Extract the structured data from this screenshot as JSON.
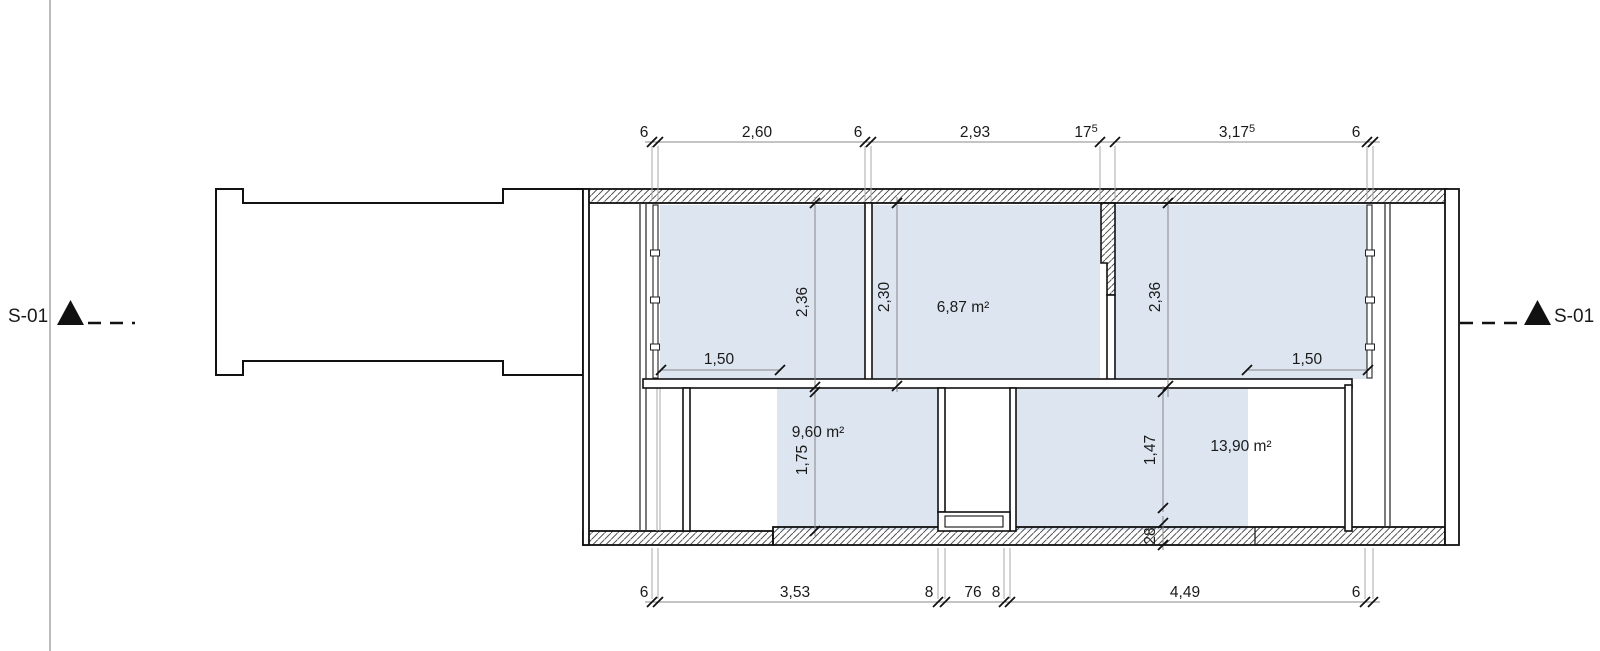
{
  "drawing": {
    "section_label_left": "S-01",
    "section_label_right": "S-01",
    "rooms": [
      {
        "name": "upper-middle-room",
        "area_label": "6,87 m²"
      },
      {
        "name": "lower-left-room",
        "area_label": "9,60 m²"
      },
      {
        "name": "lower-right-room",
        "area_label": "13,90 m²"
      }
    ],
    "dimensions": {
      "top": [
        {
          "v": "6"
        },
        {
          "v": "2,60"
        },
        {
          "v": "6"
        },
        {
          "v": "2,93"
        },
        {
          "v": "17",
          "sup": "5"
        },
        {
          "v": "3,17",
          "sup": "5"
        },
        {
          "v": "6"
        }
      ],
      "bottom": [
        {
          "v": "6"
        },
        {
          "v": "3,53"
        },
        {
          "v": "8"
        },
        {
          "v": "76"
        },
        {
          "v": "8"
        },
        {
          "v": "4,49"
        },
        {
          "v": "6"
        }
      ],
      "room_a_depth": "2,36",
      "room_b_depth": "2,30",
      "room_c_depth": "2,36",
      "lower_left_height": "1,75",
      "lower_right_height": "1,47",
      "bottom_wall_thickness": "28",
      "left_window_width": "1,50",
      "right_window_width": "1,50"
    },
    "colors": {
      "room_fill": "#dce5f0",
      "wall_line": "#111111",
      "dimension_line": "#888888"
    }
  }
}
